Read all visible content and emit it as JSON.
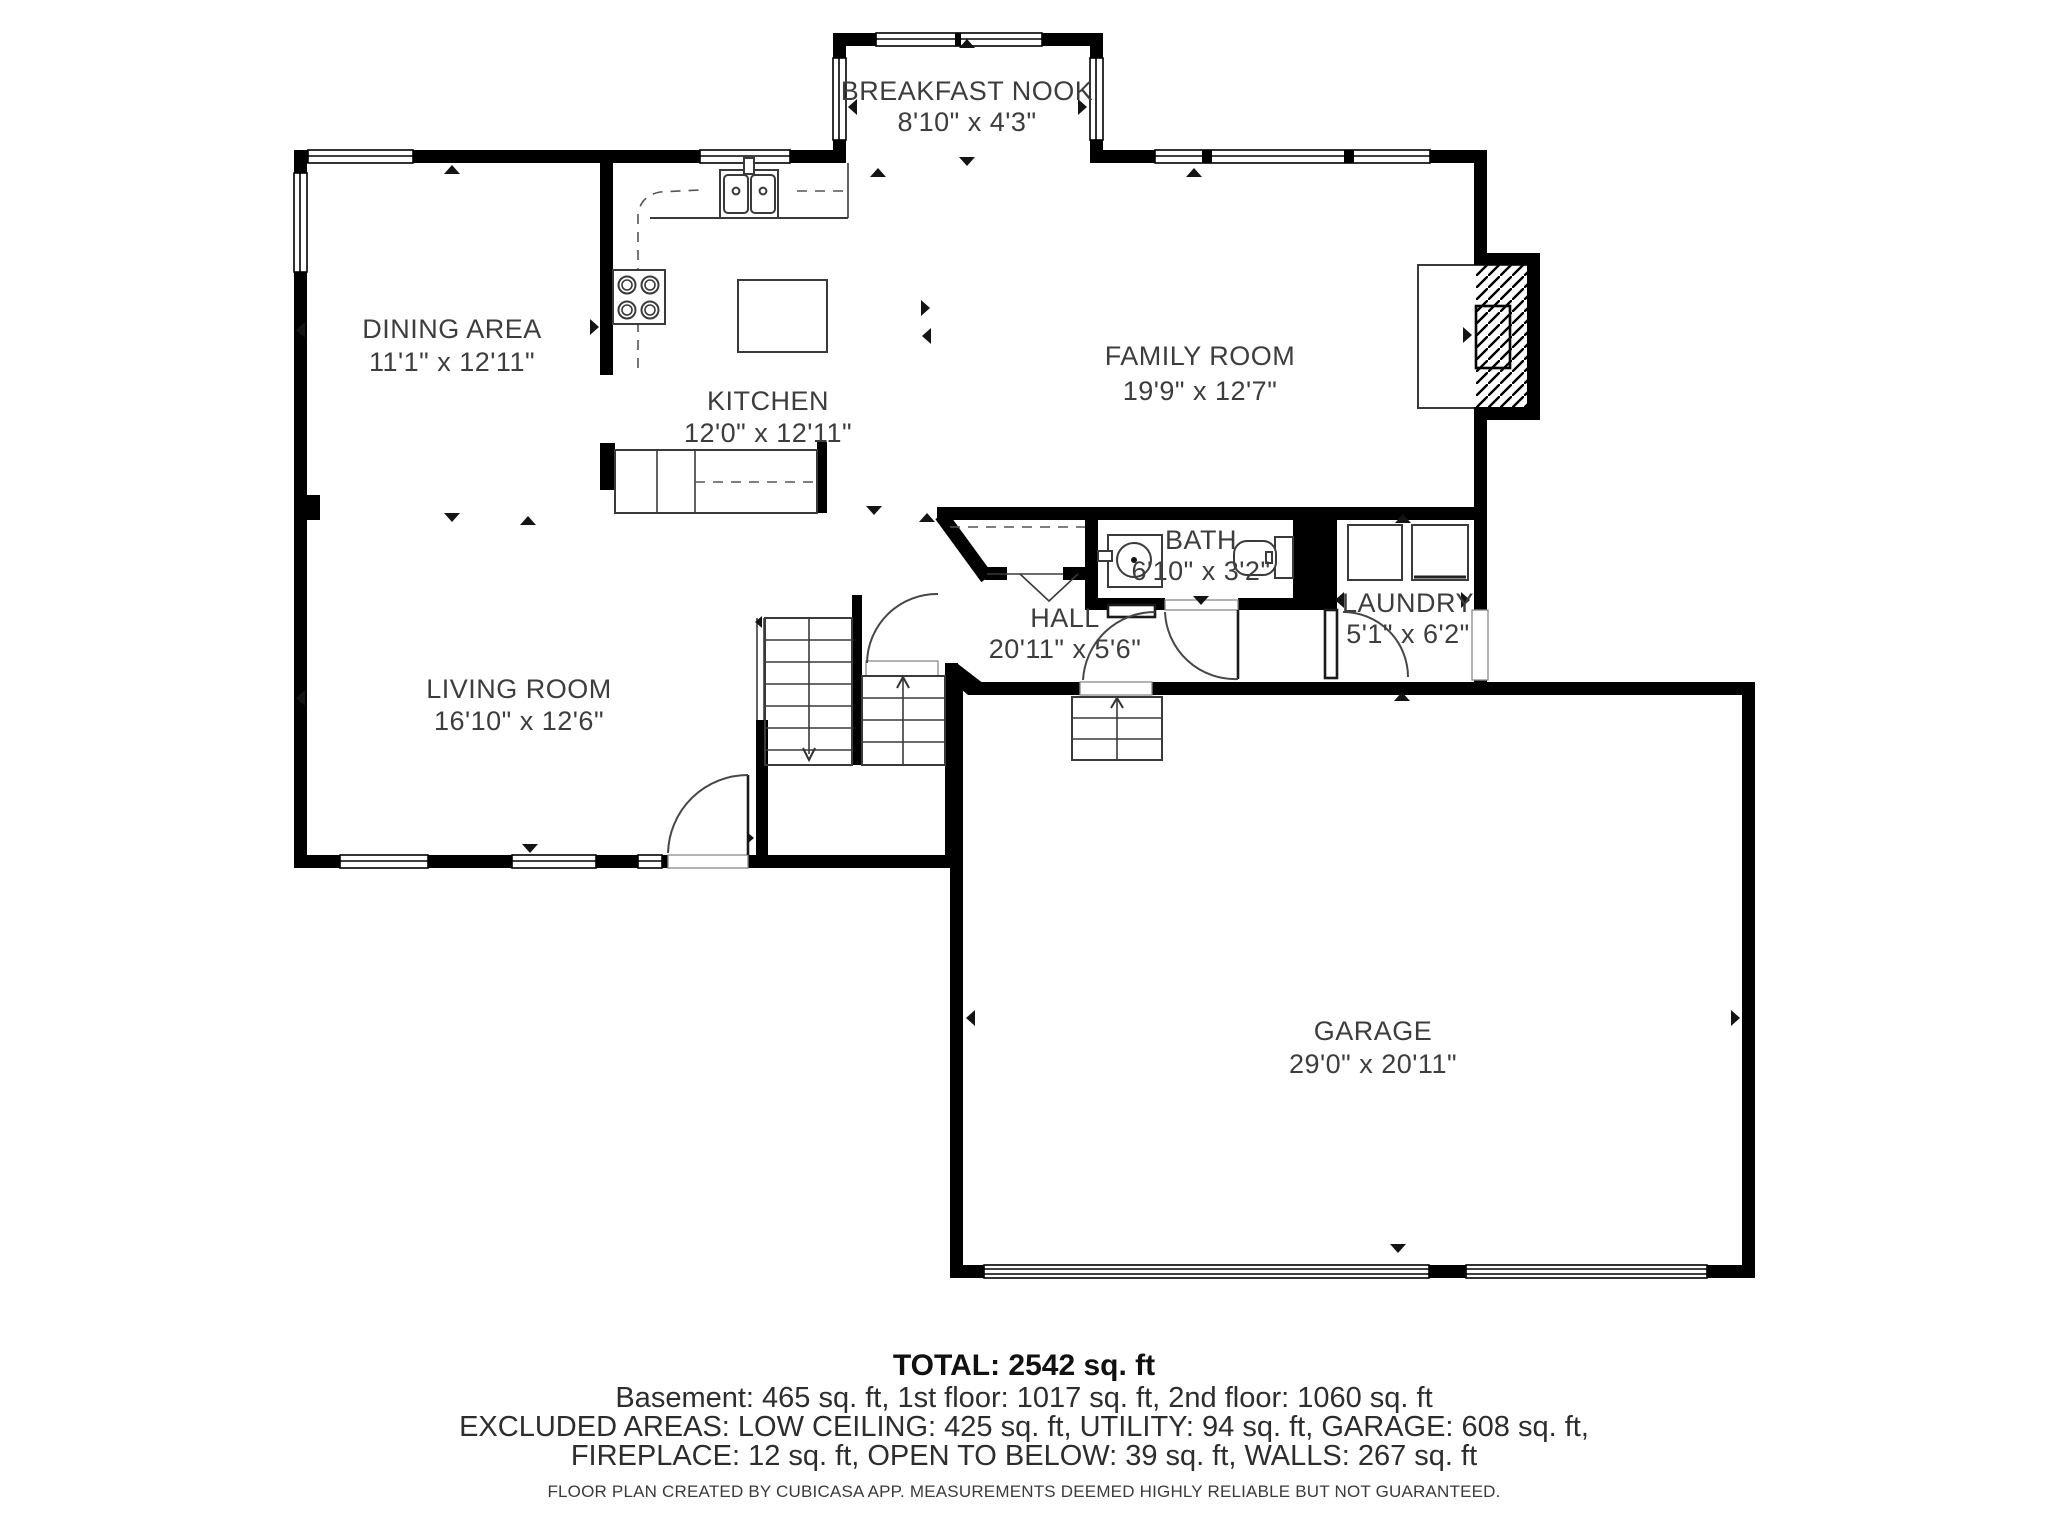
{
  "rooms": [
    {
      "name": "BREAKFAST NOOK",
      "dims": "8'10\" x 4'3\""
    },
    {
      "name": "DINING AREA",
      "dims": "11'1\" x 12'11\""
    },
    {
      "name": "KITCHEN",
      "dims": "12'0\" x 12'11\""
    },
    {
      "name": "FAMILY ROOM",
      "dims": "19'9\" x 12'7\""
    },
    {
      "name": "BATH",
      "dims": "6'10\" x 3'2\""
    },
    {
      "name": "HALL",
      "dims": "20'11\" x 5'6\""
    },
    {
      "name": "LAUNDRY",
      "dims": "5'1\" x 6'2\""
    },
    {
      "name": "LIVING ROOM",
      "dims": "16'10\" x 12'6\""
    },
    {
      "name": "GARAGE",
      "dims": "29'0\" x 20'11\""
    }
  ],
  "summary": {
    "total": "TOTAL: 2542 sq. ft",
    "floors": "Basement: 465 sq. ft, 1st floor: 1017 sq. ft, 2nd floor: 1060 sq. ft",
    "excluded1": "EXCLUDED AREAS: LOW CEILING: 425 sq. ft, UTILITY: 94 sq. ft, GARAGE: 608 sq. ft,",
    "excluded2": "FIREPLACE: 12 sq. ft, OPEN TO BELOW: 39 sq. ft, WALLS: 267 sq. ft"
  },
  "footer": "FLOOR PLAN CREATED BY CUBICASA APP. MEASUREMENTS DEEMED HIGHLY RELIABLE BUT NOT GUARANTEED.",
  "colors": {
    "wall": "#000000",
    "text": "#3d3d3d",
    "fixture": "#3a3a3a",
    "dash": "#555555"
  }
}
